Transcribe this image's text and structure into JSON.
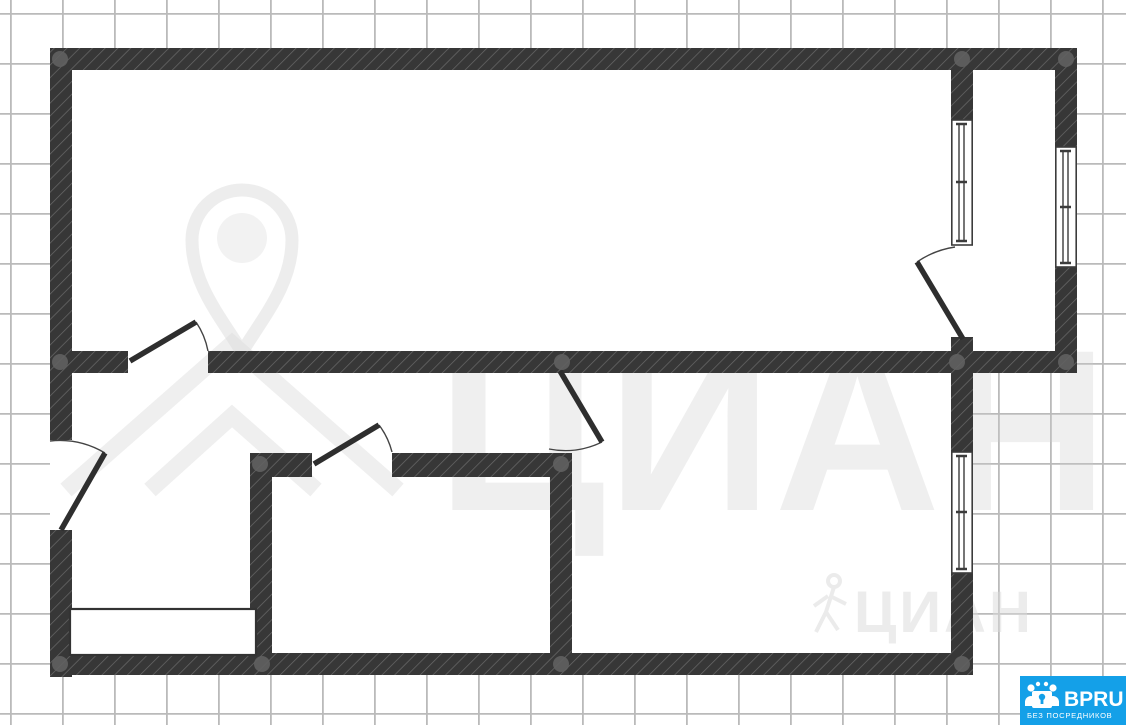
{
  "watermarks": {
    "brand_large": "ЦИАН",
    "brand_small": "ЦИАН"
  },
  "badge": {
    "title": "BPRU",
    "subtitle": "БЕЗ ПОСРЕДНИКОВ",
    "bg_color": "#14a0e8",
    "text_color": "#ffffff"
  },
  "colors": {
    "wall": "#373737",
    "wall_hatch_stripe": "#7a7a7a",
    "grid_line": "#bababa",
    "floor": "#ffffff",
    "joint_marker": "#616161",
    "door_line": "#2e2e2e",
    "window_frame": "#3c3c3c",
    "watermark_gray": "#cccccc"
  },
  "plan_symbols": {
    "window_count": 3,
    "door_count": 5,
    "bathtub_count": 1
  }
}
